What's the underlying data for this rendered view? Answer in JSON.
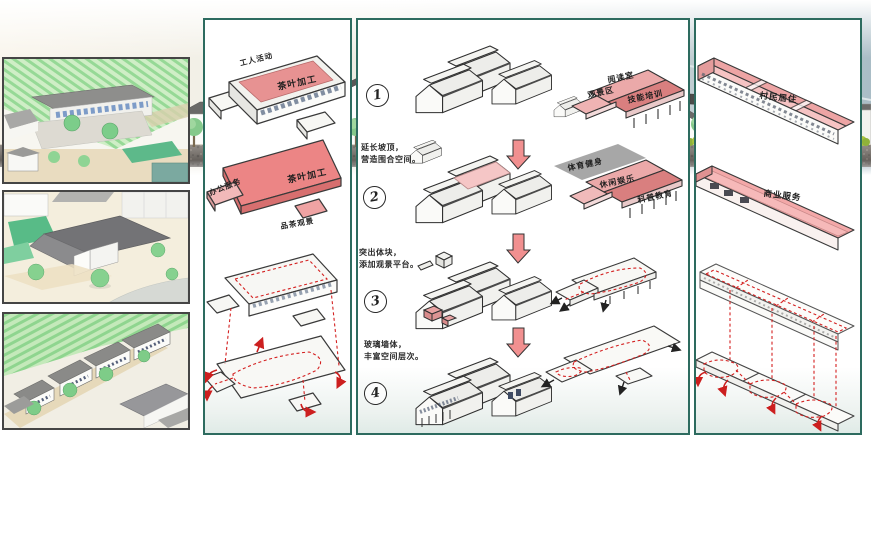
{
  "panel_left": {
    "diagram_top": {
      "top_label": "工人活动",
      "roof_label": "茶叶加工"
    },
    "diagram_mid": {
      "left_label": "办公服务",
      "roof_label": "茶叶加工",
      "bottom_label": "品茶观景"
    }
  },
  "panel_mid": {
    "steps": [
      {
        "num": "1"
      },
      {
        "num": "2"
      },
      {
        "num": "3"
      },
      {
        "num": "4"
      }
    ],
    "notes": [
      {
        "l1": "延长坡顶，",
        "l2": "营造围合空间。"
      },
      {
        "l1": "突出体块，",
        "l2": "添加观景平台。"
      },
      {
        "l1": "玻璃墙体，",
        "l2": "丰富空间层次。"
      }
    ],
    "zones_top": [
      "阅读室",
      "观景区",
      "技能培训"
    ],
    "zones_mid": [
      "体育健身",
      "休闲娱乐",
      "科普教育"
    ]
  },
  "panel_right": {
    "bar1_label": "村民居住",
    "bar2_label": "商业服务"
  },
  "colors": {
    "panel_border": "#2d6b5f",
    "roof_pink": "#ef9a9a",
    "roof_red": "#d97a7a",
    "circulation_red": "#d42020",
    "massing_gray": "#9c9c9c"
  }
}
